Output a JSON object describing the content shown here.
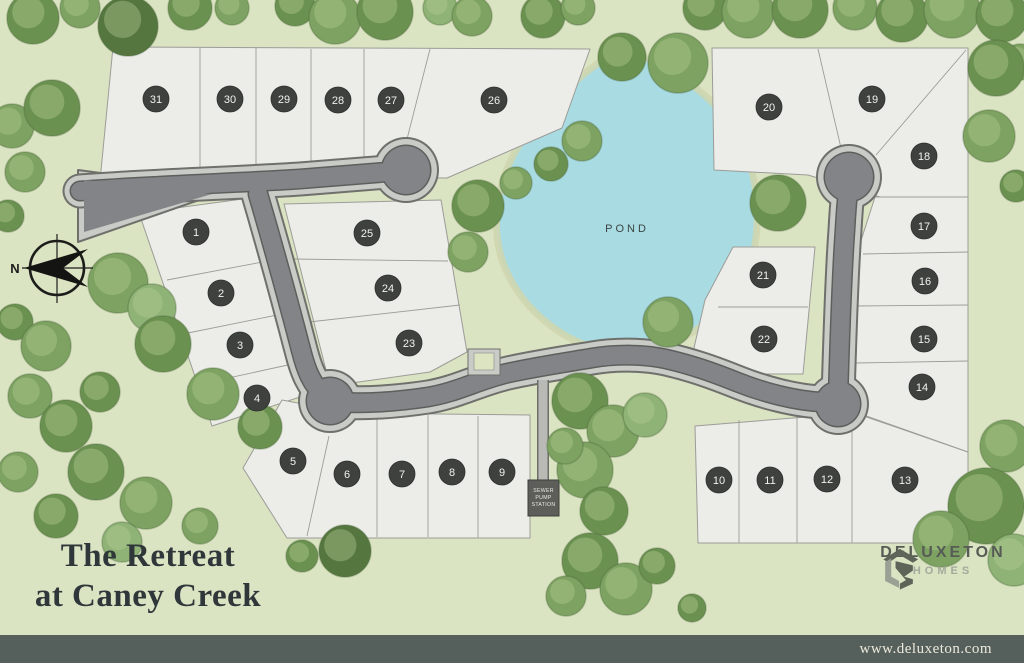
{
  "title": {
    "line1": "The Retreat",
    "line2": "at Caney Creek"
  },
  "brand": {
    "name": "DELUXETON",
    "sub": "HOMES",
    "url": "www.deluxeton.com"
  },
  "map": {
    "pond_label": "POND",
    "north_label": "N",
    "sewer_lines": [
      "SEWER",
      "PUMP",
      "STATION"
    ]
  },
  "colors": {
    "background": "#dae3c2",
    "lot_fill": "#ecede8",
    "lot_border": "#9c9c98",
    "road_asphalt": "#828488",
    "road_casing": "#c9cbc6",
    "road_outline": "#6f706c",
    "pond": "#a9dbe3",
    "badge": "#3f413f",
    "bar": "#55605d",
    "tree_palette": [
      "#7da261",
      "#6b9150",
      "#8fb277",
      "#5d8144",
      "#55763f"
    ]
  },
  "lots": [
    {
      "n": "1",
      "x": 196,
      "y": 232
    },
    {
      "n": "2",
      "x": 221,
      "y": 293
    },
    {
      "n": "3",
      "x": 240,
      "y": 345
    },
    {
      "n": "4",
      "x": 257,
      "y": 398
    },
    {
      "n": "5",
      "x": 293,
      "y": 461
    },
    {
      "n": "6",
      "x": 347,
      "y": 474
    },
    {
      "n": "7",
      "x": 402,
      "y": 474
    },
    {
      "n": "8",
      "x": 452,
      "y": 472
    },
    {
      "n": "9",
      "x": 502,
      "y": 472
    },
    {
      "n": "10",
      "x": 719,
      "y": 480
    },
    {
      "n": "11",
      "x": 770,
      "y": 480
    },
    {
      "n": "12",
      "x": 827,
      "y": 479
    },
    {
      "n": "13",
      "x": 905,
      "y": 480
    },
    {
      "n": "14",
      "x": 922,
      "y": 387
    },
    {
      "n": "15",
      "x": 924,
      "y": 339
    },
    {
      "n": "16",
      "x": 925,
      "y": 281
    },
    {
      "n": "17",
      "x": 924,
      "y": 226
    },
    {
      "n": "18",
      "x": 924,
      "y": 156
    },
    {
      "n": "19",
      "x": 872,
      "y": 99
    },
    {
      "n": "20",
      "x": 769,
      "y": 107
    },
    {
      "n": "21",
      "x": 763,
      "y": 275
    },
    {
      "n": "22",
      "x": 764,
      "y": 339
    },
    {
      "n": "23",
      "x": 409,
      "y": 343
    },
    {
      "n": "24",
      "x": 388,
      "y": 288
    },
    {
      "n": "25",
      "x": 367,
      "y": 233
    },
    {
      "n": "26",
      "x": 494,
      "y": 100
    },
    {
      "n": "27",
      "x": 391,
      "y": 100
    },
    {
      "n": "28",
      "x": 338,
      "y": 100
    },
    {
      "n": "29",
      "x": 284,
      "y": 99
    },
    {
      "n": "30",
      "x": 230,
      "y": 99
    },
    {
      "n": "31",
      "x": 156,
      "y": 99
    }
  ],
  "trees": [
    [
      33,
      18,
      26,
      1
    ],
    [
      80,
      8,
      20,
      0
    ],
    [
      128,
      26,
      30,
      4
    ],
    [
      190,
      8,
      22,
      1
    ],
    [
      232,
      8,
      17,
      0
    ],
    [
      295,
      6,
      20,
      1
    ],
    [
      335,
      18,
      26,
      0
    ],
    [
      385,
      12,
      28,
      1
    ],
    [
      440,
      8,
      17,
      2
    ],
    [
      472,
      16,
      20,
      0
    ],
    [
      543,
      16,
      22,
      1
    ],
    [
      578,
      8,
      17,
      0
    ],
    [
      622,
      57,
      24,
      1
    ],
    [
      678,
      63,
      30,
      0
    ],
    [
      705,
      8,
      22,
      1
    ],
    [
      748,
      12,
      26,
      0
    ],
    [
      800,
      10,
      28,
      1
    ],
    [
      855,
      8,
      22,
      0
    ],
    [
      902,
      16,
      26,
      1
    ],
    [
      952,
      10,
      28,
      0
    ],
    [
      1002,
      16,
      26,
      1
    ],
    [
      1020,
      62,
      18,
      0
    ],
    [
      12,
      126,
      22,
      0
    ],
    [
      52,
      108,
      28,
      1
    ],
    [
      25,
      172,
      20,
      0
    ],
    [
      8,
      216,
      16,
      1
    ],
    [
      118,
      283,
      30,
      0
    ],
    [
      152,
      308,
      24,
      2
    ],
    [
      15,
      322,
      18,
      1
    ],
    [
      46,
      346,
      25,
      0
    ],
    [
      100,
      392,
      20,
      1
    ],
    [
      30,
      396,
      22,
      0
    ],
    [
      66,
      426,
      26,
      1
    ],
    [
      18,
      472,
      20,
      0
    ],
    [
      96,
      472,
      28,
      1
    ],
    [
      146,
      503,
      26,
      0
    ],
    [
      56,
      516,
      22,
      1
    ],
    [
      200,
      526,
      18,
      0
    ],
    [
      122,
      542,
      20,
      2
    ],
    [
      163,
      344,
      28,
      1
    ],
    [
      213,
      394,
      26,
      0
    ],
    [
      260,
      427,
      22,
      1
    ],
    [
      345,
      551,
      26,
      4
    ],
    [
      302,
      556,
      16,
      1
    ],
    [
      582,
      141,
      20,
      0
    ],
    [
      551,
      164,
      17,
      1
    ],
    [
      516,
      183,
      16,
      0
    ],
    [
      478,
      206,
      26,
      1
    ],
    [
      468,
      252,
      20,
      0
    ],
    [
      778,
      203,
      28,
      1
    ],
    [
      668,
      322,
      25,
      0
    ],
    [
      580,
      401,
      28,
      1
    ],
    [
      613,
      431,
      26,
      0
    ],
    [
      645,
      415,
      22,
      2
    ],
    [
      585,
      470,
      28,
      0
    ],
    [
      604,
      511,
      24,
      1
    ],
    [
      565,
      446,
      18,
      0
    ],
    [
      590,
      561,
      28,
      1
    ],
    [
      626,
      589,
      26,
      0
    ],
    [
      657,
      566,
      18,
      1
    ],
    [
      566,
      596,
      20,
      0
    ],
    [
      692,
      608,
      14,
      1
    ],
    [
      996,
      68,
      28,
      1
    ],
    [
      989,
      136,
      26,
      0
    ],
    [
      1016,
      186,
      16,
      1
    ],
    [
      1006,
      446,
      26,
      0
    ],
    [
      986,
      506,
      38,
      1
    ],
    [
      941,
      539,
      28,
      0
    ],
    [
      1014,
      560,
      26,
      2
    ]
  ]
}
